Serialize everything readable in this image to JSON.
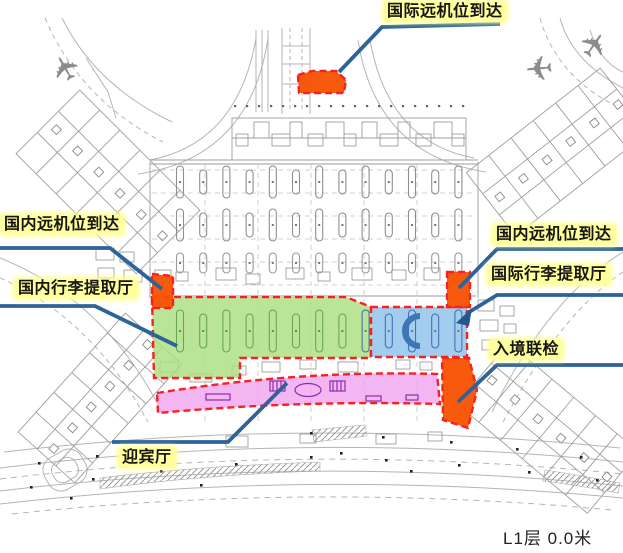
{
  "diagram": {
    "kind": "airport-terminal-floor-plan",
    "floor_label": "L1层 0.0米"
  },
  "labels": {
    "international_remote_stand_arrival": "国际远机位到达",
    "domestic_remote_stand_arrival_left": "国内远机位到达",
    "domestic_baggage_claim_hall": "国内行李提取厅",
    "domestic_remote_stand_arrival_right": "国内远机位到达",
    "international_baggage_claim_hall": "国际行李提取厅",
    "entry_joint_inspection": "入境联检",
    "welcome_hall": "迎宾厅"
  },
  "regions": {
    "international_remote_stand_arrival": {
      "color": "#f85100"
    },
    "domestic_remote_stand_arrival_left": {
      "color": "#f85100"
    },
    "domestic_remote_stand_arrival_right": {
      "color": "#f85100"
    },
    "entry_joint_inspection": {
      "color": "#f85100"
    },
    "domestic_baggage_claim_hall": {
      "color": "#abdf80"
    },
    "international_baggage_claim_hall": {
      "color": "#8fc2ec"
    },
    "welcome_hall": {
      "color": "#f1a3f0"
    }
  },
  "colors": {
    "highlight": "#ffff9c",
    "label_text": "#161616",
    "leader_line": "#2d6398",
    "region_border": "#f82020",
    "region_orange": "#f85100",
    "region_green": "#abdf80",
    "region_blue": "#8fc2ec",
    "region_pink": "#f1a3f0",
    "plan_line": "#9e9e9e"
  },
  "icons": {
    "airplane": "✈"
  }
}
